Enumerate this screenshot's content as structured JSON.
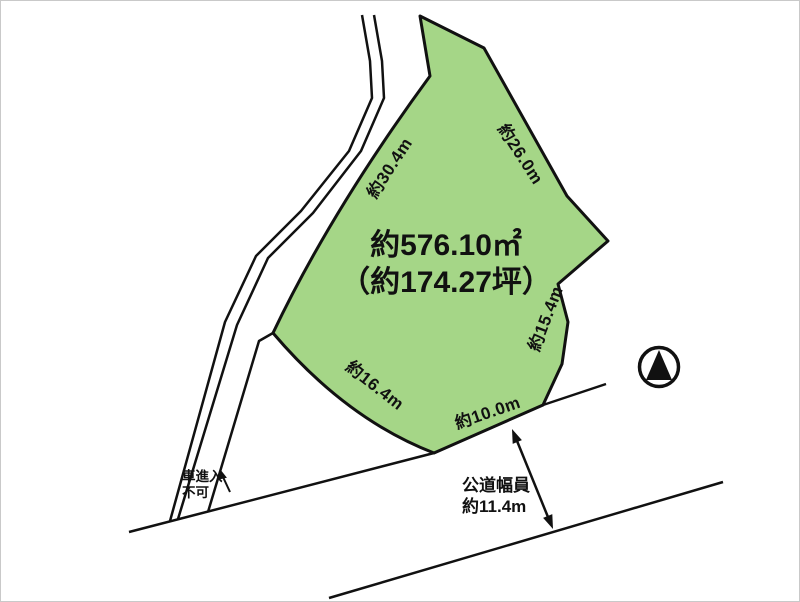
{
  "diagram": {
    "area_label": {
      "line1": "約576.10㎡",
      "line2": "（約174.27坪）"
    },
    "dimensions": [
      {
        "id": "side-upper-left",
        "text": "約30.4m"
      },
      {
        "id": "side-upper-right",
        "text": "約26.0m"
      },
      {
        "id": "side-right",
        "text": "約15.4m"
      },
      {
        "id": "side-lower-left",
        "text": "約16.4m"
      },
      {
        "id": "side-frontage",
        "text": "約10.0m"
      }
    ],
    "road_width_label": {
      "line1": "公道幅員",
      "line2": "約11.4m"
    },
    "no_entry_label": {
      "line1": "車進入",
      "line2": "不可"
    },
    "icons": {
      "north": "north-compass-icon"
    },
    "colors": {
      "plot_fill": "#a5d687",
      "line": "#111111",
      "background": "#ffffff"
    }
  }
}
